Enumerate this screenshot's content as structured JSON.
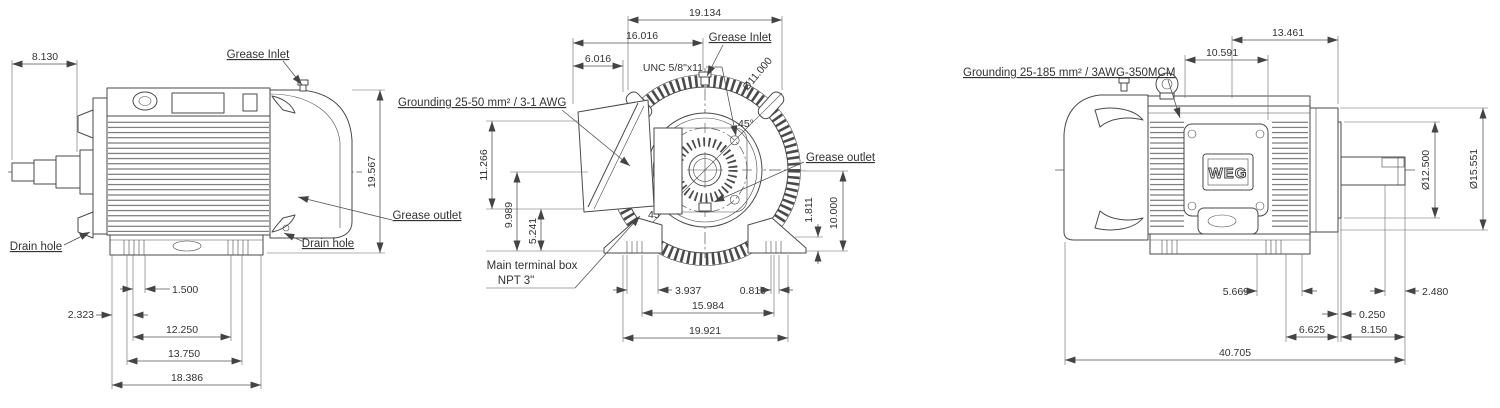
{
  "colors": {
    "background": "#ffffff",
    "line": "#4a4a4a",
    "text": "#333333"
  },
  "views": {
    "left": {
      "labels": {
        "grease_inlet": "Grease Inlet",
        "grease_outlet": "Grease outlet",
        "drain_hole_left": "Drain hole",
        "drain_hole_right": "Drain hole"
      },
      "dims": {
        "shaft_extension": "8.130",
        "overall_height": "19.567",
        "foot_slot": "1.500",
        "edge_offset": "2.323",
        "mount_holes": "12.250",
        "foot_span": "13.750",
        "base_length": "18.386"
      }
    },
    "front": {
      "labels": {
        "grease_inlet": "Grease Inlet",
        "grease_outlet": "Grease outlet",
        "tap": "UNC 5/8\"x11",
        "grounding": "Grounding 25-50 mm² / 3-1 AWG",
        "terminal_box_line1": "Main terminal box",
        "terminal_box_line2": "NPT 3\"",
        "angle_ne": "45°",
        "angle_sw": "45°"
      },
      "dims": {
        "overall_width": "19.134",
        "box_to_inlet": "16.016",
        "box_depth": "6.016",
        "bolt_circle": "Ø11.000",
        "box_height": "11.266",
        "center_height": "9.989",
        "box_bottom_height": "5.241",
        "outlet_height": "10.000",
        "foot_thickness": "1.811",
        "foot_slot": "3.937",
        "slot_width": "0.810",
        "mount_holes": "15.984",
        "base_width": "19.921"
      }
    },
    "right": {
      "labels": {
        "grounding": "Grounding 25-185 mm² / 3AWG-350MCM",
        "logo": "WEG"
      },
      "dims": {
        "plate_to_flange": "13.461",
        "eye_to_plate": "10.591",
        "spigot_diameter": "Ø12.500",
        "flange_diameter": "Ø15.551",
        "foot_slot": "5.669",
        "key_length": "2.480",
        "spigot_depth": "0.250",
        "foot_to_flange": "6.625",
        "shaft_extension": "8.150",
        "overall_length": "40.705"
      }
    }
  }
}
